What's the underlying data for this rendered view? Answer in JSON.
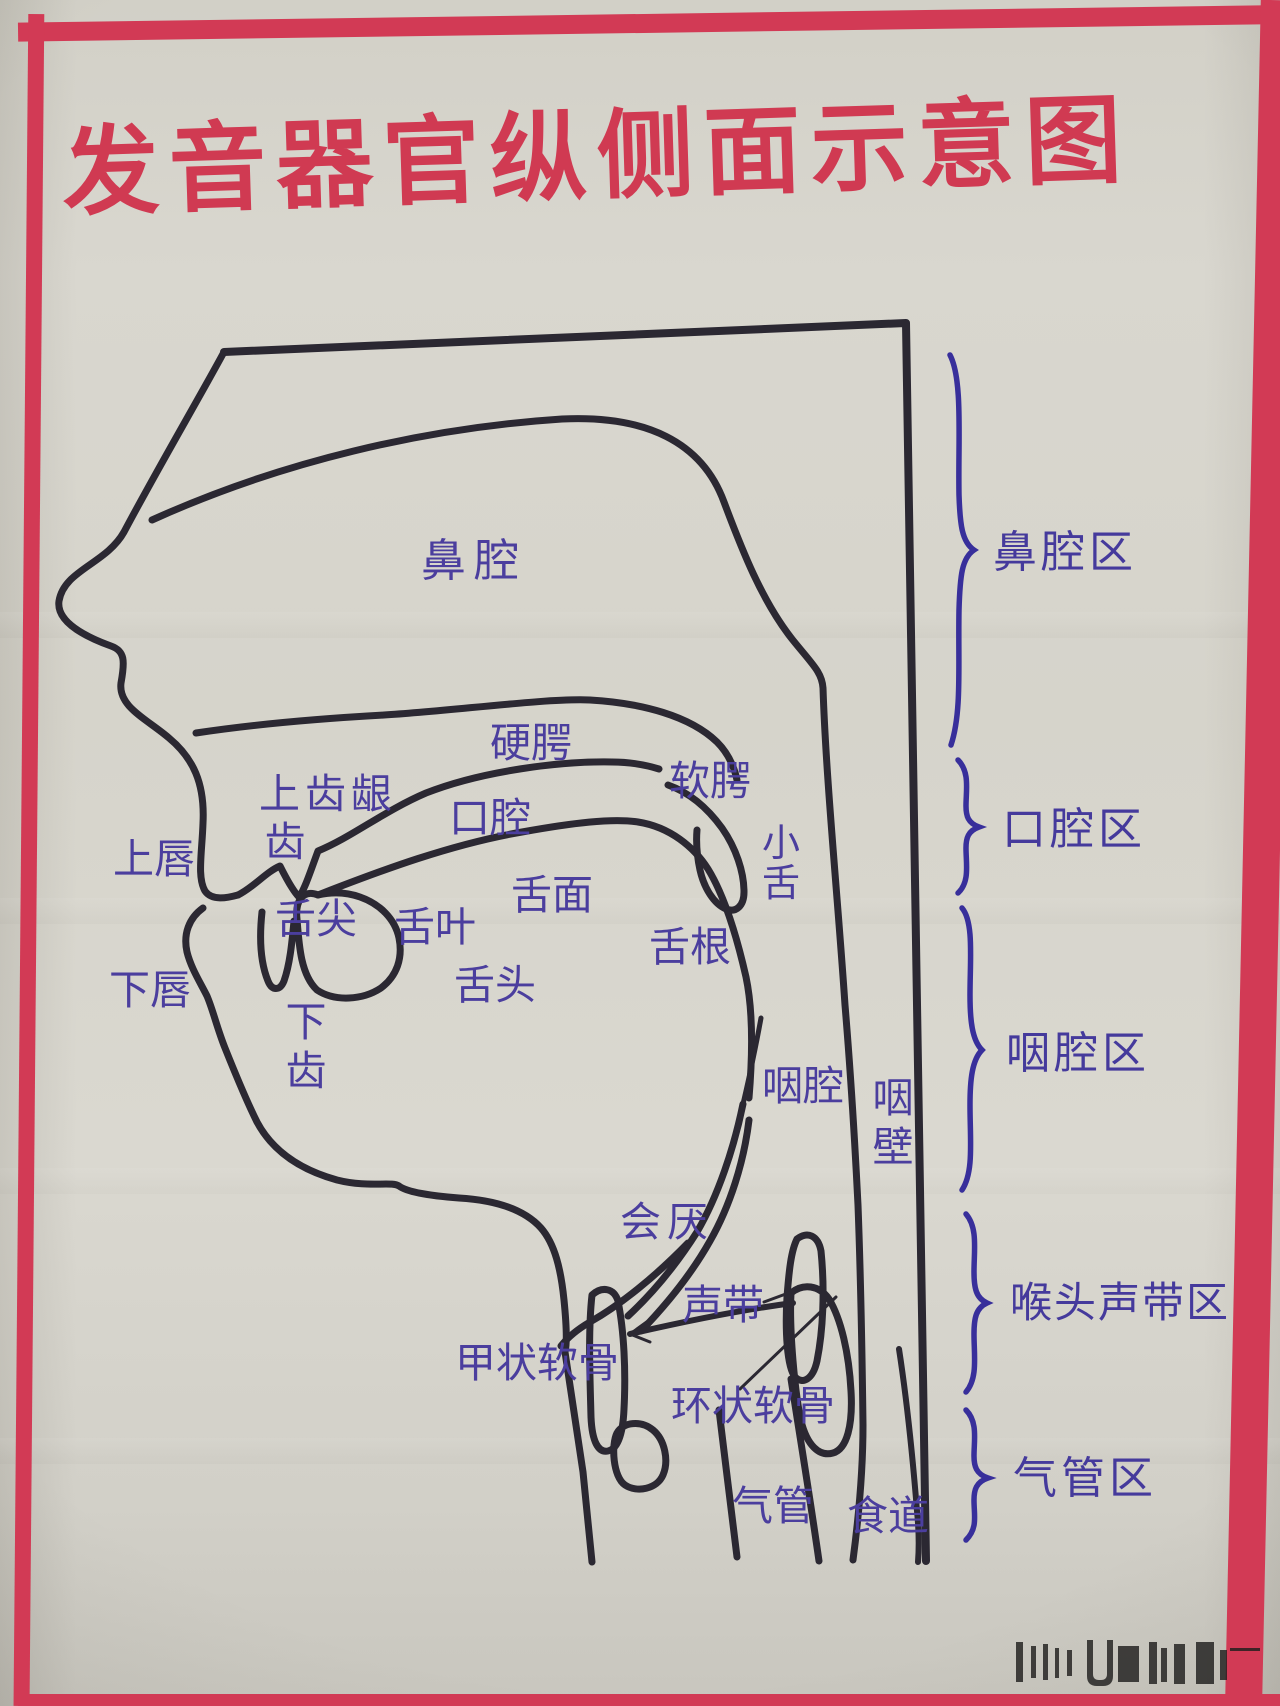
{
  "poster": {
    "title": "发音器官纵侧面示意图",
    "colors": {
      "frame_red": "#d23a55",
      "title_red": "#d03a52",
      "label_blue": "#4b3e9e",
      "brace_indigo": "#382f9b",
      "line_dark": "#2b2832",
      "paper_beige": "#d6d4cb"
    },
    "anatomy_labels": {
      "nasal_cavity": "鼻腔",
      "hard_palate": "硬腭",
      "soft_palate": "软腭",
      "upper_gum": "上齿龈",
      "upper_teeth": "齿",
      "upper_lip": "上唇",
      "oral_cavity": "口腔",
      "uvula": "小舌",
      "tongue_tip": "舌尖",
      "tongue_blade": "舌叶",
      "tongue_surface": "舌面",
      "tongue_root": "舌根",
      "tongue": "舌头",
      "lower_lip": "下唇",
      "lower_teeth": "下齿",
      "pharyngeal_cavity": "咽腔",
      "pharyngeal_wall": "咽壁",
      "epiglottis": "会厌",
      "vocal_cords": "声带",
      "thyroid_cartilage": "甲状软骨",
      "cricoid_cartilage": "环状软骨",
      "trachea": "气管",
      "esophagus": "食道"
    },
    "region_labels": {
      "nasal_region": "鼻腔区",
      "oral_region": "口腔区",
      "pharyngeal_region": "咽腔区",
      "larynx_vocal_region": "喉头声带区",
      "trachea_region": "气管区"
    }
  }
}
